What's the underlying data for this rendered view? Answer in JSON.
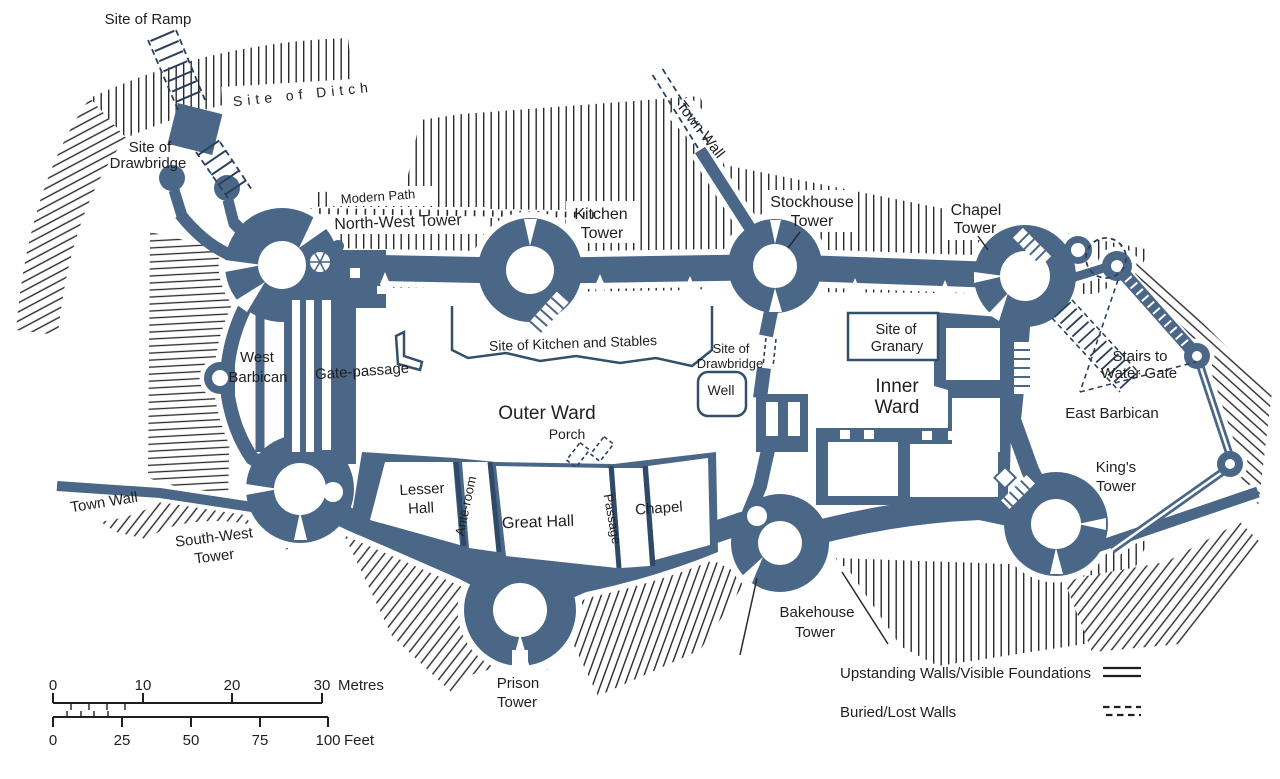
{
  "colors": {
    "wall": "#4b6787",
    "ink": "#1f1f1f",
    "paper": "#ffffff",
    "buried_line": "#2b3f5c"
  },
  "labels": {
    "site_of_ramp": "Site of Ramp",
    "site_of_ditch": "Site of Ditch",
    "site_of_drawbridge_nw": [
      "Site of",
      "Drawbridge"
    ],
    "modern_path": "Modern Path",
    "north_west_tower": "North-West Tower",
    "kitchen_tower": [
      "Kitchen",
      "Tower"
    ],
    "town_wall_north": "Town Wall",
    "stockhouse_tower": [
      "Stockhouse",
      "Tower"
    ],
    "chapel_tower": [
      "Chapel",
      "Tower"
    ],
    "stairs_to_water_gate": [
      "Stairs to",
      "Water Gate"
    ],
    "west_barbican": [
      "West",
      "Barbican"
    ],
    "gate_passage": "Gate-passage",
    "site_of_kitchen_and_stables": "Site of Kitchen and Stables",
    "site_of_drawbridge_inner": [
      "Site of",
      "Drawbridge"
    ],
    "well": "Well",
    "site_of_granary": [
      "Site of",
      "Granary"
    ],
    "inner_ward": [
      "Inner",
      "Ward"
    ],
    "outer_ward": "Outer Ward",
    "porch": "Porch",
    "east_barbican": "East Barbican",
    "kings_tower": [
      "King's",
      "Tower"
    ],
    "town_wall_west": "Town Wall",
    "south_west_tower": [
      "South-West",
      "Tower"
    ],
    "lesser_hall": [
      "Lesser",
      "Hall"
    ],
    "ante_room": "Ante-room",
    "great_hall": "Great Hall",
    "passage": "Passage",
    "chapel_room": "Chapel",
    "prison_tower": [
      "Prison",
      "Tower"
    ],
    "bakehouse_tower": [
      "Bakehouse",
      "Tower"
    ]
  },
  "scale_bar": {
    "metres_ticks": [
      "0",
      "10",
      "20",
      "30"
    ],
    "metres_unit": "Metres",
    "feet_ticks": [
      "0",
      "25",
      "50",
      "75",
      "100"
    ],
    "feet_unit": "Feet"
  },
  "legend": {
    "upstanding": "Upstanding Walls/Visible Foundations",
    "buried": "Buried/Lost Walls"
  }
}
